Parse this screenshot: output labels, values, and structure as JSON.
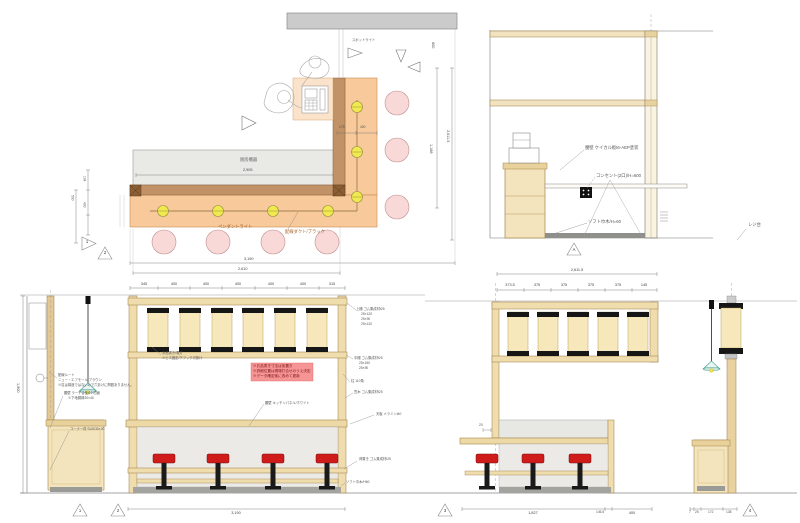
{
  "plan": {
    "labels": {
      "spotlight": "スポットライト",
      "kitchen": "厨房機器",
      "pendant": "ペンダントライト",
      "duct": "配線ダクト/ブラック"
    },
    "dims": {
      "kitchen_w": "2,905",
      "bottom_outer": "3,190",
      "bottom_inner": "2,610",
      "right_outer": "2,611.5",
      "right_inner": "1,188",
      "right_top": "600",
      "corner_a": "175",
      "corner_b": "400",
      "left_a": "134",
      "left_b": "500",
      "left_c": "400"
    },
    "markers": {
      "m1": "1",
      "m2": "2"
    }
  },
  "elev_a": {
    "labels": {
      "wall": "腰壁 ケイカル板t6-AEP塗装",
      "outlet": "コンセント(2口)/H=600",
      "skirting": "ソフト巾木/H=60",
      "register": "レジ台"
    },
    "marker": "A"
  },
  "elev_1": {
    "labels": {
      "wiring_1": "配線ルート",
      "wiring_2": "ニュー・エフモール/ブラウン",
      "wiring_3": "※柱は構造ではないので穴あけに問題ありません。",
      "wall_1": "腰壁 ラーチ合板t12 四面",
      "wall_2": "※下地胴縁30×40",
      "corner": "コーナー材 SUS/30×20"
    },
    "dims": {
      "height": "1,900"
    },
    "marker": "1"
  },
  "elev_2": {
    "top_dims": [
      "345",
      "400",
      "400",
      "400",
      "400",
      "400",
      "315"
    ],
    "labels": {
      "menu_1": "お品書き/電灯",
      "menu_2": "※ビス固定/下フック引掛け",
      "note_1": "※お品書き寸法は仮置き",
      "note_2": "※詳細位置は現場打合せのうえ決定",
      "note_3": "※データ確定後に改めて更新",
      "wall": "腰壁 キッチンパネル/ホワイト",
      "upper_shelf_1": "上棚 ゴム集成材t25",
      "upper_shelf_2": "25×120",
      "upper_shelf_3": "25×90",
      "upper_shelf_4": "25×120",
      "mid_shelf_1": "中棚 ゴム集成材t25",
      "mid_shelf_2": "25×150",
      "mid_shelf_3": "25×90",
      "post": "柱 110角",
      "coping": "笠木 ゴム集成材t25",
      "counter_top": "天板 メラミンt40",
      "shelf": "荷置き ゴム集成材t25",
      "skirting": "ソフト巾木/H60"
    },
    "dims": {
      "width": "3,190"
    },
    "marker": "2"
  },
  "elev_3": {
    "dims": {
      "overall": "2,611.5",
      "segs": [
        "373.5",
        "375",
        "375",
        "375",
        "375",
        "145"
      ],
      "side": "20",
      "w_1": "1,827",
      "w_2": "146.5",
      "w_3": "400"
    },
    "marker": "3"
  },
  "elev_4": {
    "dims": [
      "7",
      "25",
      "172",
      "138"
    ],
    "marker": "4"
  }
}
